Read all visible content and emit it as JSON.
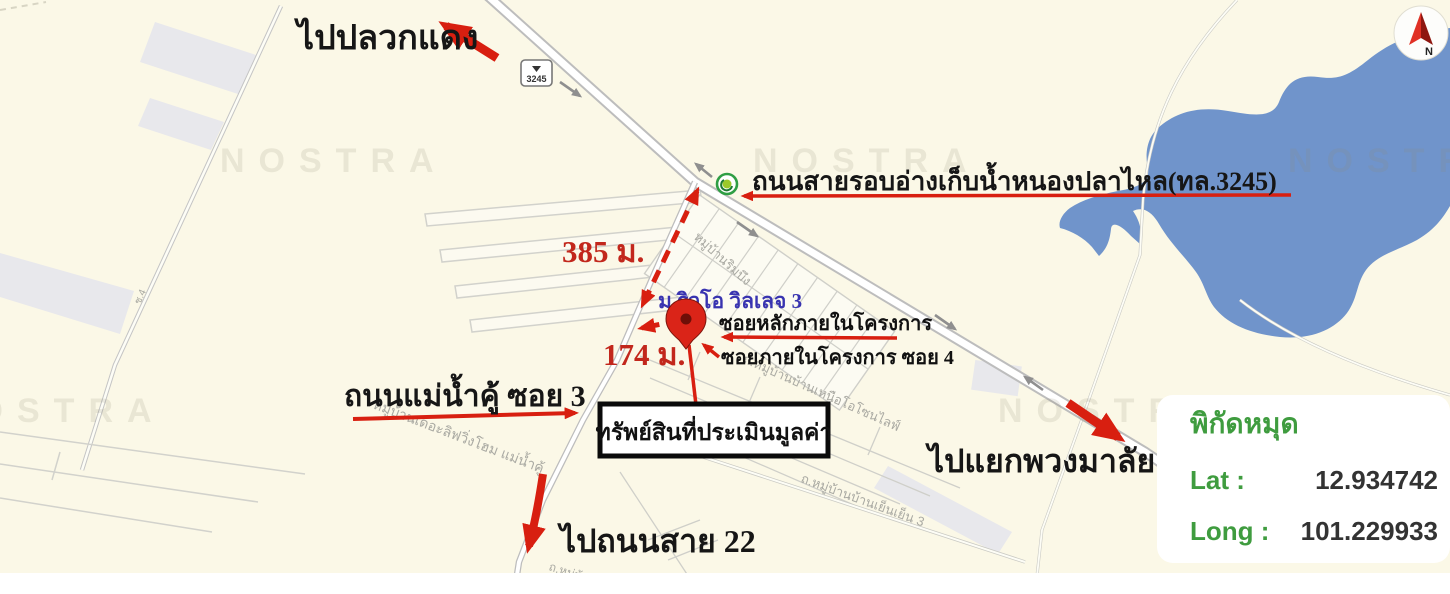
{
  "map": {
    "background_color": "#FBF8E7",
    "water_color": "#7094CB",
    "road_casing_color": "#bfbfbf",
    "watermark_text": "NOSTRA",
    "route_sign": "3245",
    "street_labels": [
      {
        "text": "ช.4"
      },
      {
        "text": "หมู่บ้านริมบึง"
      },
      {
        "text": "ถ.หมู่บ้านบ้านเหนือโอโซนไลฟ์"
      },
      {
        "text": "หมู่บ้านเดอะลิฟวิ่งโฮม แม่น้ำคู้"
      },
      {
        "text": "ถ.หมู่บ้านบ้านเย็นเย็น 3"
      },
      {
        "text": "ถ.หมู่บ้าน"
      }
    ]
  },
  "annotations": {
    "to_pluak_daeng": "ไปปลวกแดง",
    "ring_road": "ถนนสายรอบอ่างเก็บน้ำหนองปลาไหล(ทล.3245)",
    "distance_385": "385 ม.",
    "distance_174": "174 ม.",
    "village_name": "ม.ริวโอ วิลเลจ 3",
    "main_soi": "ซอยหลักภายในโครงการ",
    "inner_soi": "ซอยภายในโครงการ ซอย 4",
    "maenam_khu_soi3": "ถนนแม่น้ำคู้ ซอย 3",
    "property_box": "ทรัพย์สินที่ประเมินมูลค่า",
    "to_puang_malai": "ไปแยกพวงมาลัย",
    "to_road_22": "ไปถนนสาย 22"
  },
  "coordinates_panel": {
    "title": "พิกัดหมุด",
    "lat_label": "Lat :",
    "lat_value": "12.934742",
    "long_label": "Long :",
    "long_value": "101.229933"
  },
  "compass": {
    "letter": "N"
  },
  "colors": {
    "annotation_arrow_red": "#D81F10",
    "annotation_text_red": "#C2271C",
    "village_blue": "#3833B0",
    "panel_green": "#3F9C3F",
    "value_dark": "#333333"
  }
}
